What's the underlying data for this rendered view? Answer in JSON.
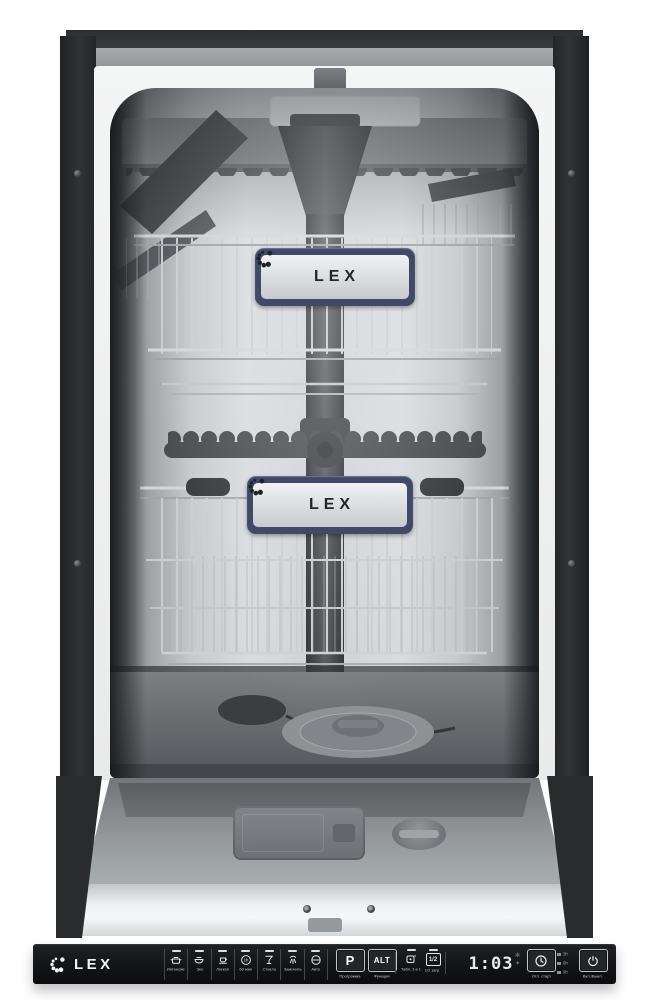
{
  "scene": {
    "type": "product-photo",
    "subject": "Built-in dishwasher with open door showing interior racks, spray tower and control panel"
  },
  "brand": {
    "name": "LEX"
  },
  "badges": {
    "upper": "LEX",
    "lower": "LEX"
  },
  "panel": {
    "logo_text": "LEX",
    "programs": [
      {
        "label": "Интенсив",
        "icon": "pot-icon"
      },
      {
        "label": "Эко",
        "icon": "plate-icon"
      },
      {
        "label": "Легкая",
        "icon": "cup-icon"
      },
      {
        "label": "60 мин",
        "icon": "clock-1h-icon",
        "icon_text": "1h"
      },
      {
        "label": "Стекло",
        "icon": "wine-glass-icon"
      },
      {
        "label": "Замочить",
        "icon": "spray-icon"
      },
      {
        "label": "Авто",
        "icon": "auto-icon"
      }
    ],
    "program_button": {
      "text": "P",
      "label": "Программа"
    },
    "function_button": {
      "text": "ALT",
      "label": "Функция"
    },
    "tabs_option": {
      "label": "Табл. 3 в 1",
      "icon": "tablet-icon"
    },
    "half_load_option": {
      "text": "1/2",
      "label": "1/2 загр."
    },
    "display": {
      "value": "1:03",
      "indicators": [
        {
          "name": "salt-indicator-icon",
          "glyph": "✻"
        },
        {
          "name": "rinse-aid-indicator-icon",
          "glyph": "✦"
        }
      ]
    },
    "delay_button": {
      "label": "Отл. старт",
      "icon": "clock-icon"
    },
    "delay_steps": [
      {
        "label": "3h"
      },
      {
        "label": "6h"
      },
      {
        "label": "9h"
      }
    ],
    "power_button": {
      "label": "Вкл./Выкл.",
      "icon": "power-icon"
    }
  },
  "colors": {
    "panel_black": "#141517",
    "badge_navy": "#3e4a68",
    "badge_silver": "#dfe2e4",
    "cabinet_dark": "#2a2c2e",
    "stainless": "#c9cdd0",
    "door_silver": "#eceeef"
  }
}
